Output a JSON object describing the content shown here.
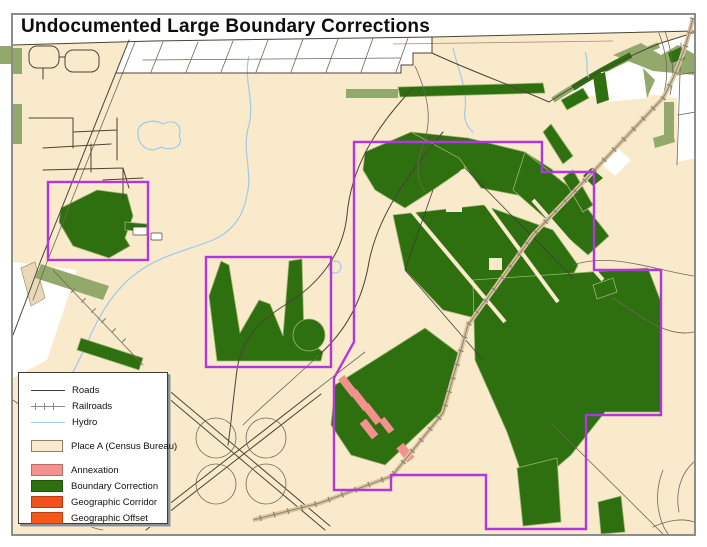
{
  "title": "Undocumented Large Boundary Corrections",
  "legend": {
    "items": [
      {
        "label": "Roads",
        "type": "line",
        "color": "#3f3a30"
      },
      {
        "label": "Railroads",
        "type": "railroad-line",
        "color": "#8a8a82"
      },
      {
        "label": "Hydro",
        "type": "line",
        "color": "#a3c8e6"
      },
      {
        "label": "Place A (Census Bureau)",
        "type": "swatch",
        "color": "#faeacc",
        "border": "#8a8070",
        "gap_before": true
      },
      {
        "label": "Annexation",
        "type": "swatch",
        "color": "#f2918e",
        "gap_before": true
      },
      {
        "label": "Boundary Correction",
        "type": "swatch",
        "color": "#2e6f10"
      },
      {
        "label": "Geographic Corridor",
        "type": "swatch",
        "color": "#f0511d"
      },
      {
        "label": "Geographic Offset",
        "type": "swatch",
        "color": "#f2591b"
      }
    ]
  },
  "colors": {
    "place_fill": "#faeacc",
    "outside_fill": "#ffffff",
    "boundary_correction": "#2e6f10",
    "olive_accent": "#93a96b",
    "annexation": "#f2918e",
    "corridor": "#f0511d",
    "offset": "#f2591b",
    "purple_boundary": "#b136dc",
    "hydro": "#a3c8e6",
    "road": "#4b4334",
    "road_minor": "#6e675a",
    "railroad": "#8a8273",
    "rail_casing": "#d9c49c",
    "frame": "#8c8c8c"
  }
}
